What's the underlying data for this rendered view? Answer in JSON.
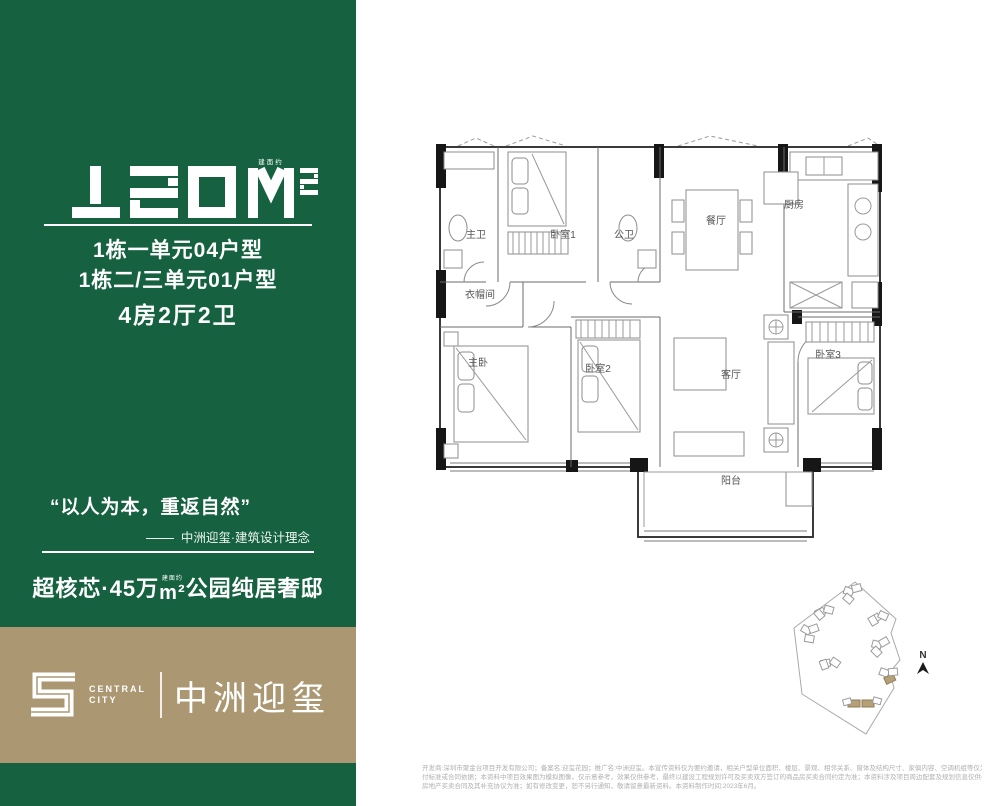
{
  "sidebar": {
    "area": {
      "value": "120M²",
      "digits": "120",
      "unit": "M²",
      "note": "建面约"
    },
    "unit_lines": [
      {
        "label": "1栋一单元04户型"
      },
      {
        "label": "1栋二/三单元01户型"
      }
    ],
    "layout_line": "4房2厅2卫",
    "quote": "“以人为本，重返自然”",
    "quote_attribution": "中洲迎玺·建筑设计理念",
    "headline": {
      "pre": "超核芯·45万",
      "unit_note": "建面约",
      "unit": "m²",
      "post": "公园纯居奢邸"
    }
  },
  "logo": {
    "mark": "square-spiral-s",
    "en_line1": "CENTRAL",
    "en_line2": "CITY",
    "cn": "中洲迎玺"
  },
  "floorplan": {
    "rooms": [
      {
        "label": "主卫"
      },
      {
        "label": "卧室1"
      },
      {
        "label": "公卫"
      },
      {
        "label": "餐厅"
      },
      {
        "label": "厨房"
      },
      {
        "label": "衣帽间"
      },
      {
        "label": "主卧"
      },
      {
        "label": "卧室2"
      },
      {
        "label": "客厅"
      },
      {
        "label": "卧室3"
      },
      {
        "label": "阳台"
      }
    ]
  },
  "siteplan": {
    "north_label": "N"
  },
  "disclaimer": {
    "lines": [
      {
        "text": "开发商:深圳市聚金台项目开发有限公司；备案名:迎玺花园；推广名:中洲迎玺。本宣传资料仅为要约邀请，相关户型单位面积、楼层、景观、相邻关系、窗体及结构尺寸、家俱内容、空调机组等仅为示意，不作为实际交"
      },
      {
        "text": "付标准或合同依据；本资料中项目效果图为模拟图像，仅示意参考，效果仅供参考，最终以建设工程规划许可及买卖双方签订的商品房买卖合同约定为准；本资料涉及项目周边配套及规划信息仅供参考，不构成出卖人的要约或承诺，买卖双方的权利义务以双方签订的深圳市"
      },
      {
        "text": "房地产买卖合同及其补充协议为准；如有修改变更，恕不另行通知，敬请留意最新资料。本资料制作时间:2023年6月。"
      }
    ]
  }
}
